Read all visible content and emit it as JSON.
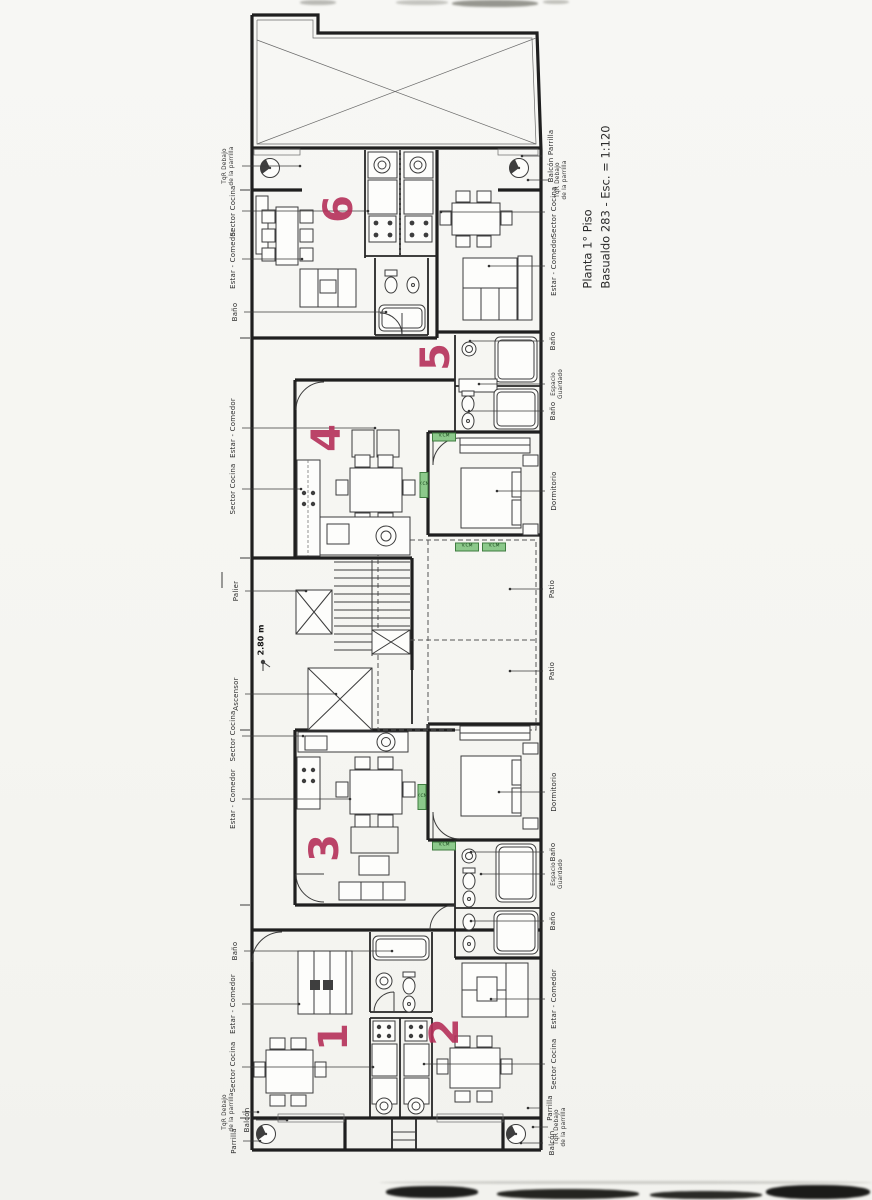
{
  "document": {
    "title_line1": "Planta 1° Piso",
    "title_line2": "Basualdo 283 - Esc. = 1:120"
  },
  "plan": {
    "level_height": "2.80 m",
    "window_tag": "V.CM",
    "unit_numbers": [
      {
        "n": "6",
        "x": 339,
        "y": 209
      },
      {
        "n": "5",
        "x": 436,
        "y": 357
      },
      {
        "n": "4",
        "x": 327,
        "y": 438
      },
      {
        "n": "3",
        "x": 325,
        "y": 848
      },
      {
        "n": "1",
        "x": 334,
        "y": 1037
      },
      {
        "n": "2",
        "x": 445,
        "y": 1032
      }
    ],
    "room_labels": [
      {
        "text": "TqR Debajo\nde la parrilla",
        "x": 229,
        "y": 166,
        "tx": 300,
        "small": true
      },
      {
        "text": "Sector Cocina",
        "x": 233,
        "y": 211,
        "tx": 368
      },
      {
        "text": "Estar - Comedor",
        "x": 233,
        "y": 259,
        "tx": 302
      },
      {
        "text": "Baño",
        "x": 235,
        "y": 312,
        "tx": 386
      },
      {
        "text": "Estar - Comedor",
        "x": 233,
        "y": 428,
        "tx": 375
      },
      {
        "text": "Sector Cocina",
        "x": 233,
        "y": 489,
        "tx": 301
      },
      {
        "text": "Palier",
        "x": 236,
        "y": 591,
        "tx": 306
      },
      {
        "text": "Ascensor",
        "x": 236,
        "y": 694,
        "tx": 336
      },
      {
        "text": "Sector Cocina",
        "x": 233,
        "y": 736,
        "tx": 303
      },
      {
        "text": "Estar - Comedor",
        "x": 233,
        "y": 799,
        "tx": 350
      },
      {
        "text": "Baño",
        "x": 235,
        "y": 951,
        "tx": 392
      },
      {
        "text": "Estar - Comedor",
        "x": 233,
        "y": 1004,
        "tx": 299
      },
      {
        "text": "Sector Cocina",
        "x": 233,
        "y": 1067,
        "tx": 373
      },
      {
        "text": "TqR Debajo\nde la parrilla",
        "x": 229,
        "y": 1112,
        "tx": 258,
        "small": true
      },
      {
        "text": "Balcón",
        "x": 247,
        "y": 1120,
        "tx": 287
      },
      {
        "text": "Parrilla",
        "x": 234,
        "y": 1141,
        "tx": 260
      },
      {
        "text": "Balcón Parrilla",
        "x": 551,
        "y": 156,
        "tx": 522
      },
      {
        "text": "TqR Debajo\nde la parrilla",
        "x": 562,
        "y": 180,
        "tx": 528,
        "small": true
      },
      {
        "text": "Sector Cocina",
        "x": 554,
        "y": 212,
        "tx": 441
      },
      {
        "text": "Estar - Comedor",
        "x": 554,
        "y": 266,
        "tx": 489
      },
      {
        "text": "Baño",
        "x": 553,
        "y": 341,
        "tx": 470
      },
      {
        "text": "Espacio\nGuardado",
        "x": 558,
        "y": 384,
        "tx": 479,
        "small": true
      },
      {
        "text": "Baño",
        "x": 553,
        "y": 411,
        "tx": 469
      },
      {
        "text": "Dormitorio",
        "x": 554,
        "y": 491,
        "tx": 497
      },
      {
        "text": "Patio",
        "x": 552,
        "y": 589,
        "tx": 510
      },
      {
        "text": "Patio",
        "x": 552,
        "y": 671,
        "tx": 510
      },
      {
        "text": "Dormitorio",
        "x": 554,
        "y": 792,
        "tx": 499
      },
      {
        "text": "Baño",
        "x": 553,
        "y": 852,
        "tx": 471
      },
      {
        "text": "Espacio\nGuardado",
        "x": 558,
        "y": 874,
        "tx": 481,
        "small": true
      },
      {
        "text": "Baño",
        "x": 553,
        "y": 921,
        "tx": 471
      },
      {
        "text": "Estar - Comedor",
        "x": 554,
        "y": 999,
        "tx": 491
      },
      {
        "text": "Sector Cocina",
        "x": 554,
        "y": 1064,
        "tx": 424
      },
      {
        "text": "Parrilla",
        "x": 550,
        "y": 1108,
        "tx": 528
      },
      {
        "text": "TqR Debajo\nde la parrilla",
        "x": 561,
        "y": 1127,
        "tx": 533,
        "small": true
      },
      {
        "text": "Balcón",
        "x": 552,
        "y": 1143,
        "tx": 521
      }
    ],
    "window_tags": [
      {
        "x": 444,
        "y": 437,
        "o": "h"
      },
      {
        "x": 424,
        "y": 485,
        "o": "v"
      },
      {
        "x": 467,
        "y": 547,
        "o": "h"
      },
      {
        "x": 494,
        "y": 547,
        "o": "h"
      },
      {
        "x": 422,
        "y": 797,
        "o": "v"
      },
      {
        "x": 444,
        "y": 846,
        "o": "h"
      }
    ]
  },
  "colors": {
    "unit_number": "#b5305a",
    "window_tag_bg": "#8cc98b",
    "ink": "#1f1f1f",
    "paper": "#f6f6f3"
  }
}
